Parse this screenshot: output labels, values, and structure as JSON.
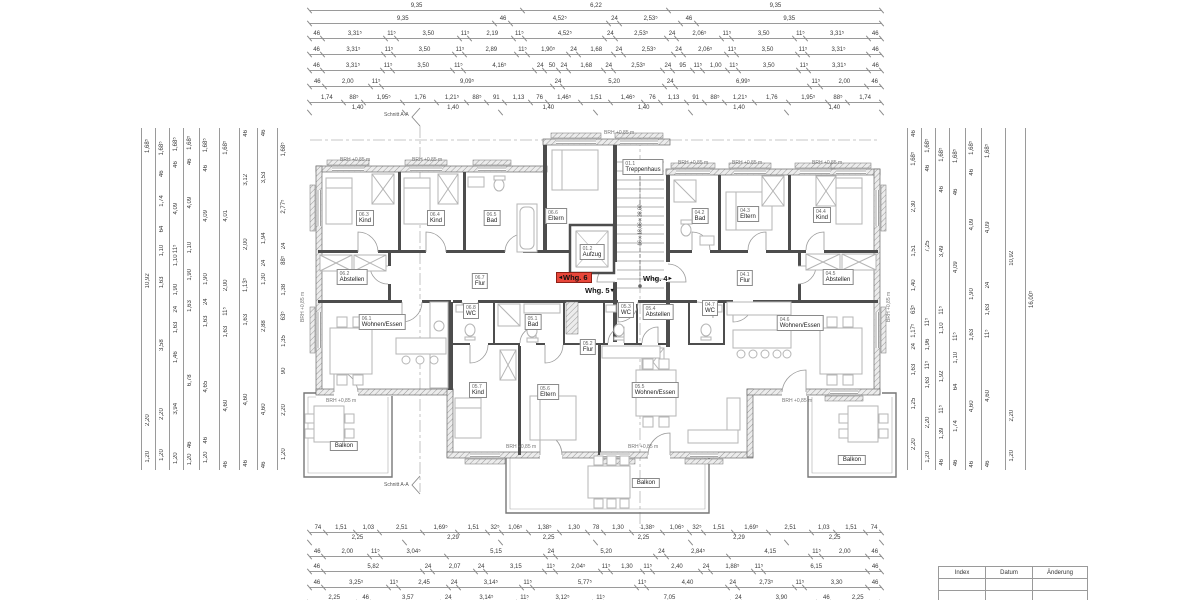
{
  "plan": {
    "section_label": "Schnitt A-A",
    "stair_note": "16 x 18,06 x 28,00",
    "brh_label": "BRH +0,85 m",
    "units": [
      {
        "label": "Whg. 6",
        "arrow": "◂",
        "x": 556,
        "y": 272,
        "cls": "highlight"
      },
      {
        "label": "Whg. 5",
        "arrow2": "▾",
        "x": 582,
        "y": 286
      },
      {
        "label": "Whg. 4",
        "arrow2": "▸",
        "x": 640,
        "y": 274
      }
    ],
    "rooms": [
      {
        "code": "06.3",
        "name": "Kind",
        "x": 365,
        "y": 218
      },
      {
        "code": "06.4",
        "name": "Kind",
        "x": 436,
        "y": 218
      },
      {
        "code": "06.5",
        "name": "Bad",
        "x": 492,
        "y": 218
      },
      {
        "code": "06.6",
        "name": "Eltern",
        "x": 556,
        "y": 216
      },
      {
        "code": "06.2",
        "name": "Abstellen",
        "x": 352,
        "y": 277
      },
      {
        "code": "06.7",
        "name": "Flur",
        "x": 480,
        "y": 281
      },
      {
        "code": "06.8",
        "name": "WC",
        "x": 471,
        "y": 311
      },
      {
        "code": "06.1",
        "name": "Wohnen/Essen",
        "x": 382,
        "y": 322
      },
      {
        "code": "01.1",
        "name": "Treppenhaus",
        "x": 643,
        "y": 167
      },
      {
        "code": "01.2",
        "name": "Aufzug",
        "x": 592,
        "y": 252
      },
      {
        "code": "05.1",
        "name": "Bad",
        "x": 533,
        "y": 322
      },
      {
        "code": "05.2",
        "name": "Flur",
        "x": 588,
        "y": 347
      },
      {
        "code": "05.3",
        "name": "WC",
        "x": 626,
        "y": 310
      },
      {
        "code": "05.4",
        "name": "Abstellen",
        "x": 658,
        "y": 312
      },
      {
        "code": "05.7",
        "name": "Kind",
        "x": 478,
        "y": 390
      },
      {
        "code": "05.6",
        "name": "Eltern",
        "x": 548,
        "y": 392
      },
      {
        "code": "05.5",
        "name": "Wohnen/Essen",
        "x": 655,
        "y": 390
      },
      {
        "code": "04.2",
        "name": "Bad",
        "x": 700,
        "y": 216
      },
      {
        "code": "04.3",
        "name": "Eltern",
        "x": 748,
        "y": 214
      },
      {
        "code": "04.4",
        "name": "Kind",
        "x": 822,
        "y": 215
      },
      {
        "code": "04.1",
        "name": "Flur",
        "x": 745,
        "y": 278
      },
      {
        "code": "04.5",
        "name": "Abstellen",
        "x": 838,
        "y": 277
      },
      {
        "code": "04.7",
        "name": "WC",
        "x": 710,
        "y": 308
      },
      {
        "code": "04.6",
        "name": "Wohnen/Essen",
        "x": 800,
        "y": 323
      }
    ],
    "balconies": [
      {
        "t": "Balkon",
        "x": 344,
        "y": 446
      },
      {
        "t": "Balkon",
        "x": 646,
        "y": 483
      },
      {
        "t": "Balkon",
        "x": 852,
        "y": 460
      }
    ],
    "brh_marks": [
      {
        "t": "BRH +0,85 m",
        "x": 340,
        "y": 157
      },
      {
        "t": "BRH +0,85 m",
        "x": 412,
        "y": 157
      },
      {
        "t": "BRH +0,85 m",
        "x": 604,
        "y": 130
      },
      {
        "t": "BRH +0,85 m",
        "x": 678,
        "y": 160
      },
      {
        "t": "BRH +0,85 m",
        "x": 732,
        "y": 160
      },
      {
        "t": "BRH +0,85 m",
        "x": 812,
        "y": 160
      },
      {
        "t": "BRH +0,85 m",
        "x": 326,
        "y": 398
      },
      {
        "t": "BRH +0,85 m",
        "x": 506,
        "y": 444
      },
      {
        "t": "BRH +0,85 m",
        "x": 628,
        "y": 444
      },
      {
        "t": "BRH +0,85 m",
        "x": 782,
        "y": 398
      },
      {
        "t": "BRH +0,85 m",
        "x": 886,
        "y": 322,
        "cls": "rot"
      },
      {
        "t": "BRH +0,85 m",
        "x": 300,
        "y": 322,
        "cls": "rot"
      }
    ]
  },
  "dims": {
    "top": {
      "r1": [
        "9,35",
        "6,22",
        "9,35"
      ],
      "r2": [
        "9,35",
        "46",
        "4,52⁵",
        "24",
        "2,53⁵",
        "46",
        "9,35"
      ],
      "r3": [
        "46",
        "3,31⁵",
        "11⁵",
        "3,50",
        "11⁵",
        "2,19",
        "11⁵",
        "4,52⁵",
        "24",
        "2,53⁵",
        "24",
        "2,06⁵",
        "11⁵",
        "3,50",
        "11⁵",
        "3,31⁵",
        "46"
      ],
      "r4": [
        "46",
        "3,31⁵",
        "11⁵",
        "3,50",
        "11⁵",
        "2,89",
        "11⁵",
        "1,90⁵",
        "24",
        "1,68",
        "24",
        "2,53⁵",
        "24",
        "2,06⁵",
        "11⁵",
        "3,50",
        "11⁵",
        "3,31⁵",
        "46"
      ],
      "r5": [
        "46",
        "3,31⁵",
        "11⁵",
        "3,50",
        "11⁵",
        "4,16⁵",
        "24",
        "50",
        "24",
        "1,68",
        "24",
        "2,53⁵",
        "24",
        "95",
        "11⁵",
        "1,00",
        "11⁵",
        "3,50",
        "11⁵",
        "3,31⁵",
        "46"
      ],
      "r6": [
        "46",
        "2,00",
        "11⁵",
        "9,09⁵",
        "24",
        "5,20",
        "24",
        "6,99⁵",
        "11⁵",
        "2,00",
        "46"
      ],
      "r7": [
        "1,74",
        "88⁵",
        "1,95⁵",
        "1,76",
        "1,21⁵",
        "88⁵",
        "91",
        "1,13",
        "76",
        "1,46⁵",
        "1,51",
        "1,46⁵",
        "76",
        "1,13",
        "91",
        "88⁵",
        "1,21⁵",
        "1,76",
        "1,95⁵",
        "88⁵",
        "1,74"
      ],
      "r8": [
        "1,40",
        "1,40",
        "1,40",
        "1,40",
        "1,40",
        "1,40"
      ]
    },
    "bottom": {
      "r1": [
        "74",
        "1,51",
        "1,03",
        "2,51",
        "1,69⁵",
        "1,51",
        "32⁵",
        "1,06⁵",
        "1,38⁵",
        "1,30",
        "78",
        "1,30",
        "1,38⁵",
        "1,06⁵",
        "32⁵",
        "1,51",
        "1,69⁵",
        "2,51",
        "1,03",
        "1,51",
        "74"
      ],
      "r2": [
        "2,25",
        "2,29",
        "2,25",
        "2,25",
        "2,29",
        "2,25"
      ],
      "r3": [
        "46",
        "2,00",
        "11⁵",
        "3,04⁵",
        "5,15",
        "24",
        "5,20",
        "24",
        "2,84⁵",
        "4,15",
        "11⁵",
        "2,00",
        "46"
      ],
      "r4": [
        "46",
        "5,82",
        "24",
        "2,07",
        "24",
        "3,15",
        "11⁵",
        "2,04⁵",
        "11⁵",
        "1,30",
        "11⁵",
        "2,40",
        "24",
        "1,88⁵",
        "11⁵",
        "6,15",
        "46"
      ],
      "r5": [
        "46",
        "3,25⁵",
        "11⁵",
        "2,45",
        "24",
        "3,14⁵",
        "11⁵",
        "5,77⁵",
        "11⁵",
        "4,40",
        "24",
        "2,73⁵",
        "11⁵",
        "3,30",
        "46"
      ],
      "r6": [
        "2,25",
        "46",
        "3,57",
        "24",
        "3,14⁵",
        "11⁵",
        "3,12⁵",
        "11⁵",
        "7,05",
        "24",
        "3,90",
        "46",
        "2,25"
      ]
    },
    "left": {
      "c1": [
        "1,68⁵",
        "10,92",
        "2,20",
        "1,20"
      ],
      "c2": [
        "1,68⁵",
        "46",
        "1,74",
        "64",
        "1,10",
        "1,63",
        "3,58",
        "2,20",
        "1,20"
      ],
      "c3": [
        "1,68⁵",
        "46",
        "4,09",
        "11⁵",
        "1,10",
        "1,90",
        "24",
        "1,63",
        "1,46",
        "3,94",
        "1,20"
      ],
      "c4": [
        "1,68⁵",
        "46",
        "4,09",
        "1,10",
        "1,90",
        "1,63",
        "6,78",
        "46",
        "1,20"
      ],
      "c5": [
        "1,68⁵",
        "46",
        "4,09",
        "1,90",
        "24",
        "1,63",
        "4,65",
        "46",
        "1,20"
      ],
      "c6": [
        "1,68⁵",
        "4,01",
        "2,00",
        "11⁵",
        "1,63",
        "4,60",
        "46"
      ],
      "c7": [
        "46",
        "3,12",
        "2,00",
        "1,13⁵",
        "1,63",
        "4,60",
        "46"
      ],
      "c8": [
        "46",
        "3,53",
        "1,94",
        "24",
        "1,30",
        "2,88",
        "4,60",
        "46"
      ],
      "c9": [
        "1,68⁵",
        "2,77⁵",
        "24",
        "88⁵",
        "1,38",
        "63⁵",
        "1,35",
        "90",
        "2,20",
        "1,20"
      ]
    },
    "right": {
      "c1": [
        "46",
        "1,68⁵",
        "2,30",
        "1,51",
        "1,40",
        "63⁵",
        "1,17⁵",
        "24",
        "1,63",
        "1,25",
        "2,20"
      ],
      "c2": [
        "1,68⁵",
        "46",
        "7,25",
        "11⁵",
        "1,96",
        "11⁵",
        "1,63",
        "2,20",
        "1,20"
      ],
      "c3": [
        "1,68⁵",
        "46",
        "3,49",
        "11⁵",
        "1,10",
        "1,92",
        "11⁵",
        "1,39",
        "46"
      ],
      "c4": [
        "1,68⁵",
        "46",
        "4,09",
        "11⁵",
        "1,10",
        "64",
        "1,74",
        "46"
      ],
      "c5": [
        "1,68⁵",
        "46",
        "4,09",
        "1,90",
        "1,63",
        "4,60",
        "46"
      ],
      "c6": [
        "1,68⁵",
        "4,09",
        "24",
        "1,63",
        "11⁵",
        "4,60",
        "46"
      ],
      "c7": [
        "10,92",
        "2,20",
        "1,20"
      ],
      "c8": [
        "16,00⁵"
      ]
    }
  },
  "revision_table": {
    "headers": [
      "Index",
      "Datum",
      "Änderung"
    ]
  },
  "colors": {
    "wall": "#4d4d4d",
    "highlight_red": "#e8463a"
  }
}
